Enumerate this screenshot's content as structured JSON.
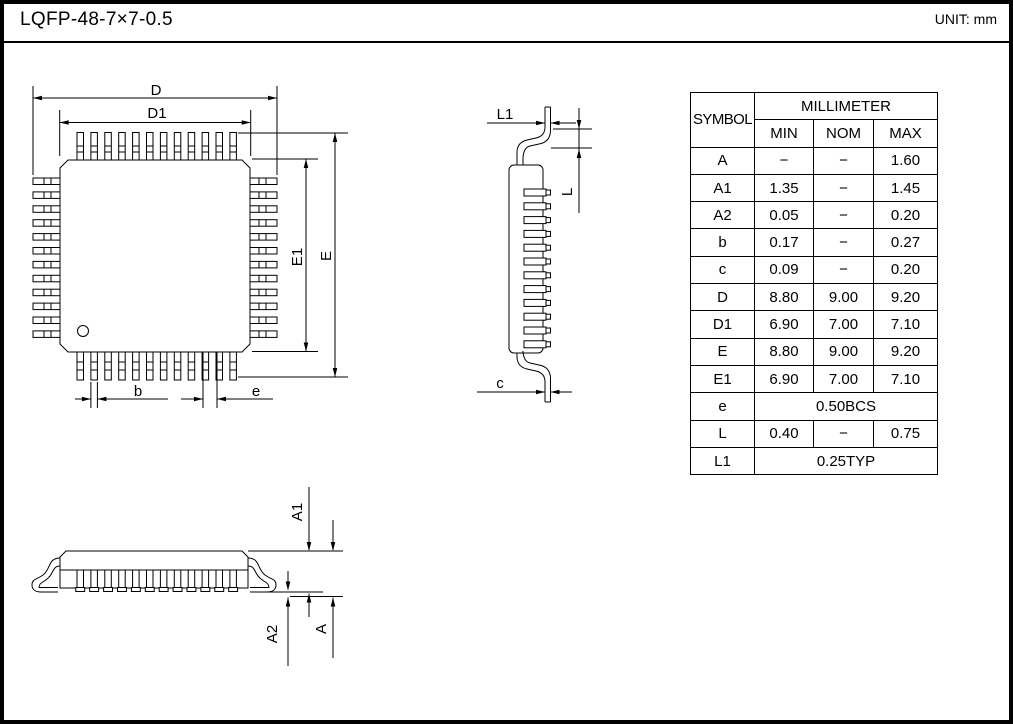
{
  "page": {
    "title": "LQFP-48-7×7-0.5",
    "unit_note": "UNIT: mm"
  },
  "table": {
    "symbol_header": "SYMBOL",
    "unit_group_header": "MILLIMETER",
    "columns": [
      "MIN",
      "NOM",
      "MAX"
    ],
    "rows": [
      {
        "symbol": "A",
        "min": "−",
        "nom": "−",
        "max": "1.60"
      },
      {
        "symbol": "A1",
        "min": "1.35",
        "nom": "−",
        "max": "1.45"
      },
      {
        "symbol": "A2",
        "min": "0.05",
        "nom": "−",
        "max": "0.20"
      },
      {
        "symbol": "b",
        "min": "0.17",
        "nom": "−",
        "max": "0.27"
      },
      {
        "symbol": "c",
        "min": "0.09",
        "nom": "−",
        "max": "0.20"
      },
      {
        "symbol": "D",
        "min": "8.80",
        "nom": "9.00",
        "max": "9.20"
      },
      {
        "symbol": "D1",
        "min": "6.90",
        "nom": "7.00",
        "max": "7.10"
      },
      {
        "symbol": "E",
        "min": "8.80",
        "nom": "9.00",
        "max": "9.20"
      },
      {
        "symbol": "E1",
        "min": "6.90",
        "nom": "7.00",
        "max": "7.10"
      },
      {
        "symbol": "e",
        "value": "0.50BCS"
      },
      {
        "symbol": "L",
        "min": "0.40",
        "nom": "−",
        "max": "0.75"
      },
      {
        "symbol": "L1",
        "value": "0.25TYP"
      }
    ]
  },
  "views": {
    "top": {
      "d": "D",
      "d1": "D1",
      "e": "E",
      "e1": "E1",
      "b": "b",
      "pitch": "e"
    },
    "side": {
      "l1": "L1",
      "l": "L",
      "c": "c"
    },
    "front": {
      "a1": "A1",
      "a2": "A2",
      "a": "A"
    }
  }
}
